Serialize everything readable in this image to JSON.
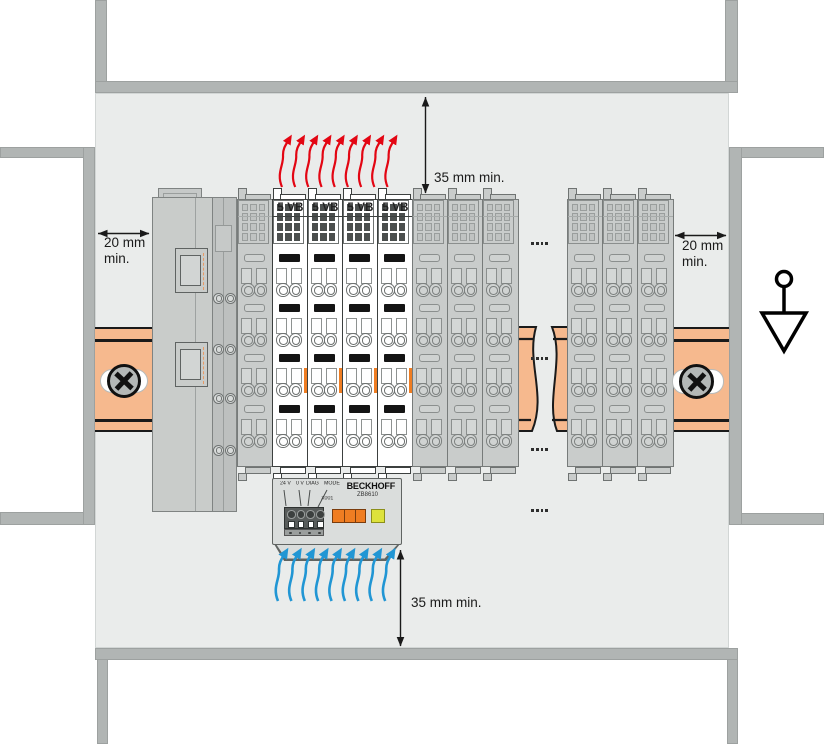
{
  "diagram": {
    "title": "Control cabinet installation clearances with fan cartridge",
    "brand": "BECKHOFF"
  },
  "annotations": {
    "top_clearance": "35 mm min.",
    "bottom_clearance": "35 mm min.",
    "left_clearance": "20 mm min.",
    "right_clearance": "20 mm min."
  },
  "fan_module": {
    "labels": {
      "supply": "24 V",
      "zero": "0 V",
      "diag": "DIAG",
      "mode": "MODE",
      "port": "X001"
    },
    "brand": "BECKHOFF",
    "model": "ZB8610"
  },
  "terminal_strip": {
    "segments": [
      {
        "type": "coupler"
      },
      {
        "type": "gray"
      },
      {
        "type": "white",
        "label": "5 VB"
      },
      {
        "type": "white",
        "label": "5 VB"
      },
      {
        "type": "white",
        "label": "5 VB"
      },
      {
        "type": "white",
        "label": "5 VB"
      },
      {
        "type": "gray"
      },
      {
        "type": "gray"
      },
      {
        "type": "gray"
      },
      {
        "type": "gap"
      },
      {
        "type": "gray"
      },
      {
        "type": "gray"
      },
      {
        "type": "gray"
      }
    ]
  },
  "airflow": {
    "heat_arrows": 9,
    "cool_arrows": 9
  },
  "continuation_dots": {
    "groups": 4,
    "dots_per_group": 4
  },
  "icons": [
    "ground-symbol",
    "din-rail-screw",
    "heat-arrow",
    "cool-air-arrow"
  ],
  "colors": {
    "heat_arrow_red": "#e30613",
    "airflow_blue": "#2196d4",
    "din_rail_orange": "#f6b98e",
    "accent_orange": "#ef7d22",
    "led_yellow": "#dde23c",
    "panel_gray": "#eaeceb",
    "frame_gray": "#b1b5b4"
  }
}
